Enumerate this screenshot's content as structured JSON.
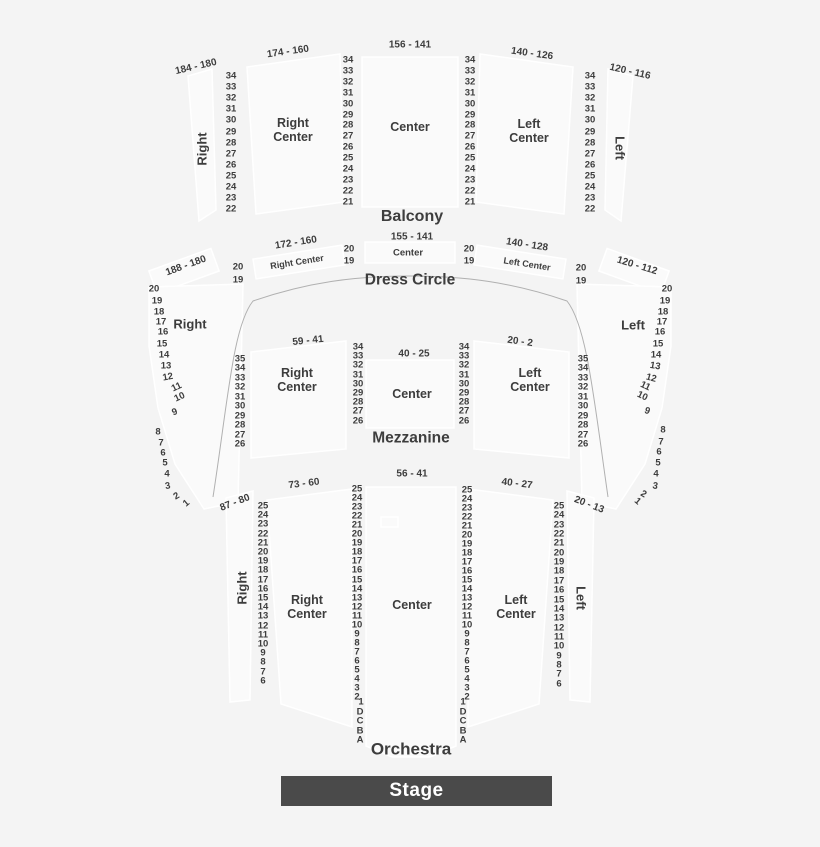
{
  "stage": {
    "label": "Stage"
  },
  "levels": {
    "balcony": {
      "title": "Balcony",
      "right": {
        "range": "184 - 180",
        "label": "Right"
      },
      "right_center": {
        "range": "174 - 160",
        "label": "Right\nCenter"
      },
      "center": {
        "range": "156 - 141",
        "label": "Center"
      },
      "left_center": {
        "range": "140 - 126",
        "label": "Left\nCenter"
      },
      "left": {
        "range": "120 - 116",
        "label": "Left"
      }
    },
    "dress_circle": {
      "title": "Dress Circle",
      "right": {
        "range": "188 - 180"
      },
      "right_center": {
        "range": "172 - 160",
        "label": "Right Center"
      },
      "center": {
        "range": "155 - 141",
        "label": "Center"
      },
      "left_center": {
        "range": "140 - 128",
        "label": "Left Center"
      },
      "left": {
        "range": "120 - 112"
      }
    },
    "mezzanine": {
      "title": "Mezzanine",
      "right": {
        "label": "Right"
      },
      "right_center": {
        "range": "59 - 41",
        "label": "Right\nCenter"
      },
      "center": {
        "range": "40 - 25",
        "label": "Center"
      },
      "left_center": {
        "range": "20 - 2",
        "label": "Left\nCenter"
      },
      "left": {
        "label": "Left"
      }
    },
    "orchestra": {
      "title": "Orchestra",
      "right": {
        "range": "87 - 80",
        "label": "Right"
      },
      "right_center": {
        "range": "73 - 60",
        "label": "Right\nCenter"
      },
      "center": {
        "range": "56 - 41",
        "label": "Center"
      },
      "left_center": {
        "range": "40 - 27",
        "label": "Left\nCenter"
      },
      "left": {
        "range": "20 - 13",
        "label": "Left"
      }
    }
  },
  "rows": {
    "balcony_outer": [
      "34",
      "33",
      "32",
      "31",
      "30",
      "29",
      "28",
      "27",
      "26",
      "25",
      "24",
      "23",
      "22"
    ],
    "balcony_inner": [
      "34",
      "33",
      "32",
      "31",
      "30",
      "29",
      "28",
      "27",
      "26",
      "25",
      "24",
      "23",
      "22",
      "21"
    ],
    "dress_circle": [
      "20",
      "19"
    ],
    "mezzanine_outer": [
      "35",
      "34",
      "33",
      "32",
      "31",
      "30",
      "29",
      "28",
      "27",
      "26"
    ],
    "mezzanine_inner": [
      "34",
      "33",
      "32",
      "31",
      "30",
      "29",
      "28",
      "27",
      "26"
    ],
    "side_wing": [
      "20",
      "19",
      "18",
      "17",
      "16",
      "15",
      "14",
      "13",
      "12",
      "11",
      "10",
      "9",
      "8",
      "7",
      "6",
      "5",
      "4",
      "3",
      "2",
      "1"
    ],
    "orchestra_outer": [
      "25",
      "24",
      "23",
      "22",
      "21",
      "20",
      "19",
      "18",
      "17",
      "16",
      "15",
      "14",
      "13",
      "12",
      "11",
      "10",
      "9",
      "8",
      "7",
      "6"
    ],
    "orchestra_inner": [
      "25",
      "24",
      "23",
      "22",
      "21",
      "20",
      "19",
      "18",
      "17",
      "16",
      "15",
      "14",
      "13",
      "12",
      "11",
      "10",
      "9",
      "8",
      "7",
      "6",
      "5",
      "4",
      "3",
      "2",
      "1",
      "D",
      "C",
      "B",
      "A"
    ]
  },
  "colors": {
    "background": "#f4f4f4",
    "section_fill": "#fafafa",
    "section_stroke": "#ffffff",
    "divider_line": "#b0b0b0",
    "text": "#3d3d3d",
    "stage_bg": "#4a4a4a",
    "stage_text": "#ffffff"
  }
}
